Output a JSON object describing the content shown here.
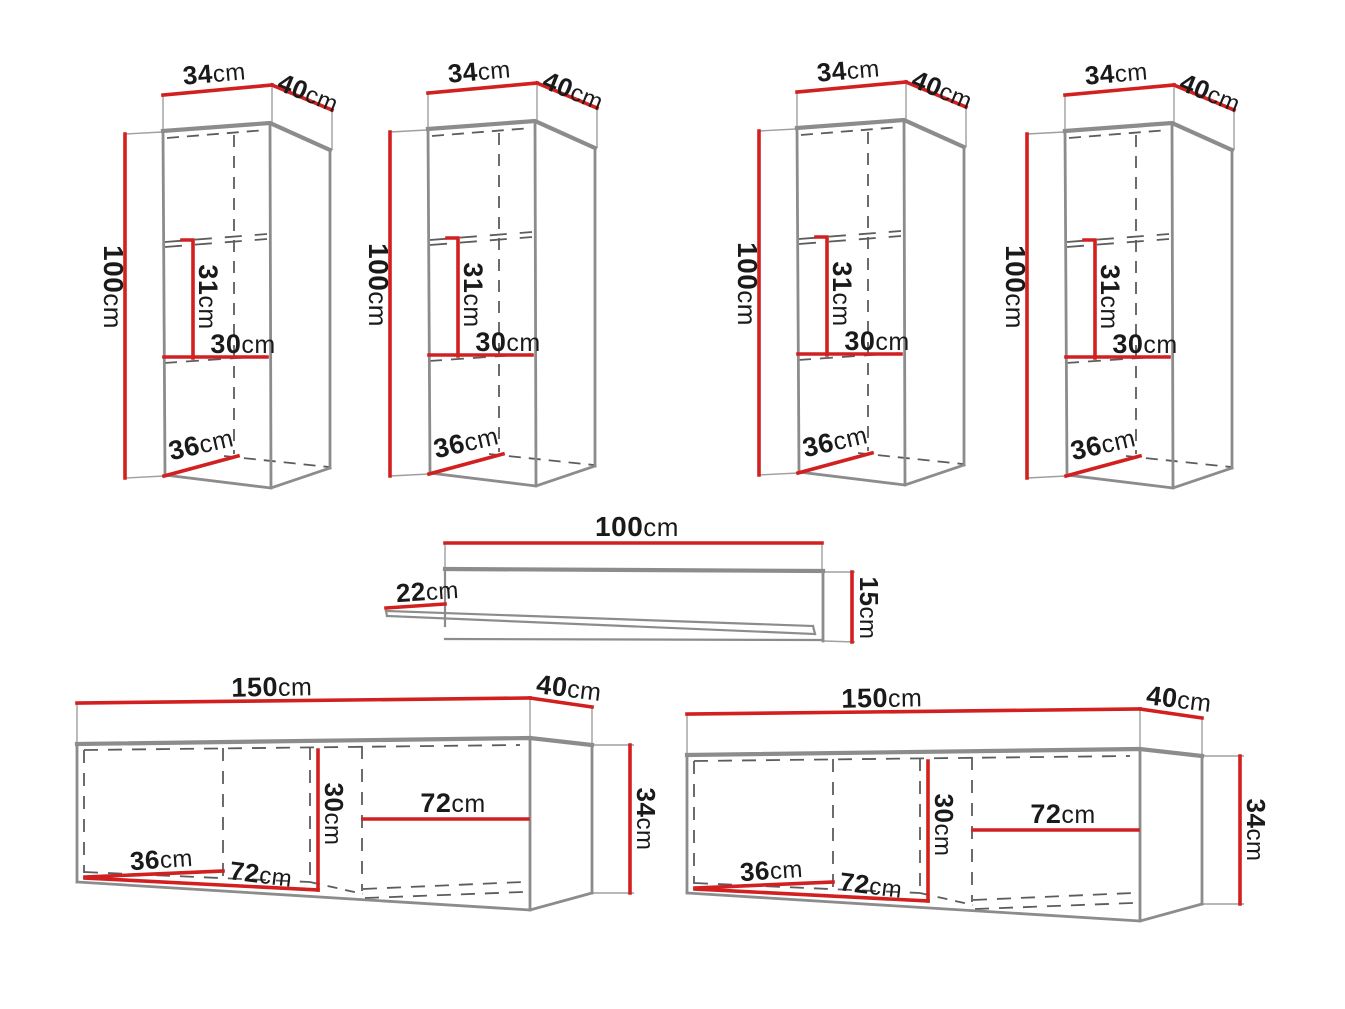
{
  "diagram_title": "furniture-set-dimension-drawing",
  "colors": {
    "background": "#ffffff",
    "dimension_red": "#d22020",
    "outline_gray": "#8c8c8c",
    "hidden_dash_gray": "#5c5c5c",
    "extension_gray": "#9f9f9f",
    "text_dark": "#1a1a1a"
  },
  "wall_cabinet": {
    "count": 4,
    "labels": {
      "width": {
        "value": "34",
        "unit": "cm"
      },
      "depth": {
        "value": "40",
        "unit": "cm"
      },
      "height": {
        "value": "100",
        "unit": "cm"
      },
      "upper_inner_height": {
        "value": "31",
        "unit": "cm"
      },
      "inner_width": {
        "value": "30",
        "unit": "cm"
      },
      "inner_depth": {
        "value": "36",
        "unit": "cm"
      }
    }
  },
  "wall_shelf": {
    "count": 1,
    "labels": {
      "width": {
        "value": "100",
        "unit": "cm"
      },
      "depth": {
        "value": "22",
        "unit": "cm"
      },
      "height": {
        "value": "15",
        "unit": "cm"
      }
    }
  },
  "tv_cabinet": {
    "count": 2,
    "labels": {
      "width": {
        "value": "150",
        "unit": "cm"
      },
      "depth": {
        "value": "40",
        "unit": "cm"
      },
      "height": {
        "value": "34",
        "unit": "cm"
      },
      "inner_height": {
        "value": "30",
        "unit": "cm"
      },
      "right_inner_width": {
        "value": "72",
        "unit": "cm"
      },
      "inner_depth": {
        "value": "36",
        "unit": "cm"
      },
      "left_inner_width": {
        "value": "72",
        "unit": "cm"
      }
    }
  }
}
